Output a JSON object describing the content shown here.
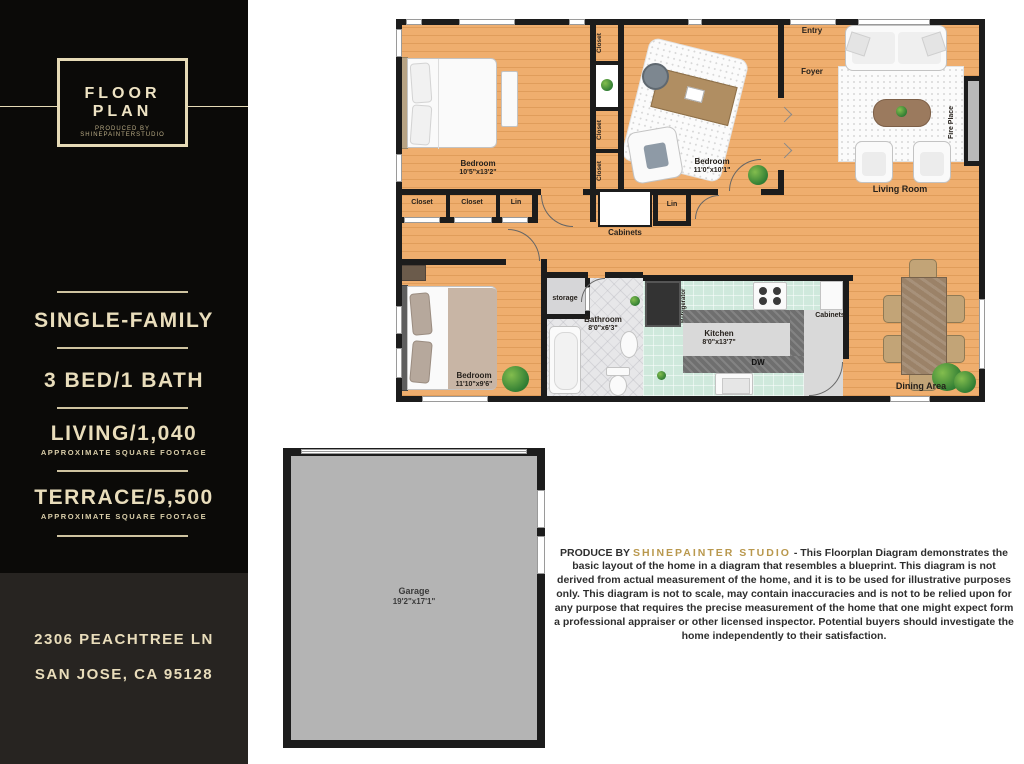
{
  "sidebar": {
    "logo": {
      "title": "FLOOR PLAN",
      "subtitle": "PRODUCED BY SHINEPAINTERSTUDIO"
    },
    "facts": [
      {
        "label": "SINGLE-FAMILY",
        "sub": ""
      },
      {
        "label": "3 BED/1 BATH",
        "sub": ""
      },
      {
        "label": "LIVING/1,040",
        "sub": "APPROXIMATE SQUARE FOOTAGE"
      },
      {
        "label": "TERRACE/5,500",
        "sub": "APPROXIMATE SQUARE FOOTAGE"
      }
    ],
    "address_line1": "2306 PEACHTREE LN",
    "address_line2": "SAN JOSE, CA 95128"
  },
  "plan": {
    "rooms": {
      "bedroom1": {
        "name": "Bedroom",
        "dims": "10'5\"x13'2\""
      },
      "bedroom2": {
        "name": "Bedroom",
        "dims": "11'0\"x10'1\""
      },
      "bedroom3": {
        "name": "Bedroom",
        "dims": "11'10\"x9'6\""
      },
      "bathroom": {
        "name": "Bathroom",
        "dims": "8'0\"x6'3\""
      },
      "kitchen": {
        "name": "Kitchen",
        "dims": "8'0\"x13'7\""
      },
      "living": {
        "name": "Living Room"
      },
      "dining": {
        "name": "Dining Area"
      },
      "entry": {
        "name": "Entry"
      },
      "foyer": {
        "name": "Foyer"
      },
      "storage": {
        "name": "storage"
      },
      "garage": {
        "name": "Garage",
        "dims": "19'2\"x17'1\""
      }
    },
    "labels": {
      "closet": "Closet",
      "lin": "Lin",
      "cabinets": "Cabinets",
      "dw": "DW",
      "refrigerator": "Refrigerator",
      "fireplace": "Fire Place"
    }
  },
  "disclaimer": {
    "prefix": "PRODUCE BY",
    "studio": "SHINEPAINTER STUDIO",
    "body": "- This Floorplan Diagram demonstrates the basic layout of the home in a diagram that resembles a blueprint. This diagram is not derived from actual measurement of the home, and it is to be used for illustrative purposes only. This diagram is not to scale, may contain inaccuracies and is not to be relied upon for any purpose that requires the precise measurement of the home that one might expect form a professional appraiser or other licensed inspector. Potential buyers should investigate the home independently to their satisfaction."
  },
  "colors": {
    "accent_cream": "#e9ddbb",
    "studio_gold": "#b9984d",
    "floor_orange": "#efae6e",
    "kitchen_teal": "#cfe9dc",
    "wall_black": "#1c1c1c",
    "garage_gray": "#b4b4b4"
  }
}
